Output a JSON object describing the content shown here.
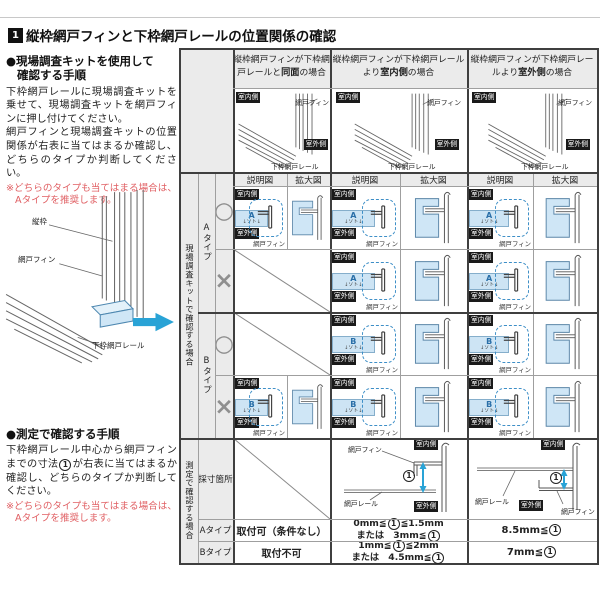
{
  "header": {
    "number": "1",
    "title": "縦枠網戸フィンと下枠網戸レールの位置関係の確認"
  },
  "left_panel": {
    "kit_section": {
      "heading_line1": "●現場調査キットを使用して",
      "heading_line2": "確認する手順",
      "body1": "下枠網戸レールに現場調査キットを乗せて、現場調査キットを網戸フィンに押し付けてください。",
      "body2": "網戸フィンと現場調査キットの位置関係が右表に当てはまるか確認し、どちらのタイプか判断してください。",
      "note_line1": "※どちらのタイプも当てはまる場合は、",
      "note_line2": "Aタイプを推奨します。"
    },
    "measure_section": {
      "heading": "●測定で確認する手順",
      "body": "下枠網戸レール中心から網戸フィンまでの寸法①が右表に当てはまるか確認し、どちらのタイプか判断してください。",
      "note_line1": "※どちらのタイプも当てはまる場合は、",
      "note_line2": "Aタイプを推奨します。"
    }
  },
  "labels": {
    "indoor": "室内側",
    "outdoor": "室外側",
    "fin": "網戸フィン",
    "tate": "縦枠",
    "rail": "下枠網戸レール",
    "rail_short": "網戸レール",
    "soto": "↓ソト↓",
    "dim": "①"
  },
  "table": {
    "columns": [
      {
        "pre": "縦枠網戸フィンが下枠網戸レールと",
        "em": "同面",
        "post": "の場合"
      },
      {
        "pre": "縦枠網戸フィンが下枠網戸レールより",
        "em": "室内側",
        "post": "の場合"
      },
      {
        "pre": "縦枠網戸フィンが下枠網戸レールより",
        "em": "室外側",
        "post": "の場合"
      }
    ],
    "sub_headers": {
      "explain": "説明図",
      "enlarge": "拡大図"
    },
    "kit_side_label": "現場調査キットで確認する場合",
    "types": [
      {
        "label": "Aタイプ",
        "kit": "A"
      },
      {
        "label": "Bタイプ",
        "kit": "B"
      }
    ],
    "marks": {
      "ok": "○",
      "ng": "×"
    },
    "measure_side_label": "測定で確認する場合",
    "measure_row_label": "採寸箇所",
    "result_rows": [
      {
        "type": "Aタイプ",
        "flush": "取付可（条件なし）",
        "indoor_line1": "0mm≦①≦1.5mm",
        "indoor_line2": "または　3mm≦①",
        "outdoor": "8.5mm≦①"
      },
      {
        "type": "Bタイプ",
        "flush": "取付不可",
        "indoor_line1": "1mm≦①≦2mm",
        "indoor_line2": "または　4.5mm≦①",
        "outdoor": "7mm≦①"
      }
    ]
  }
}
